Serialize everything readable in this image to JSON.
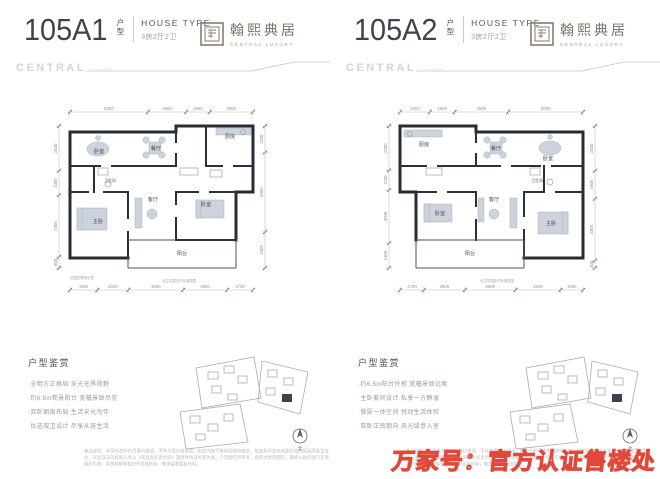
{
  "watermark": {
    "text": "万家号：官方认证售楼处",
    "color": "#e2483a"
  },
  "panels": [
    {
      "header": {
        "number": "105A1",
        "unit_top": "户",
        "unit_bottom": "型",
        "house_type": "HOUSE TYPE",
        "layout": "3房2厅2卫"
      },
      "brand": {
        "name": "翰熙典居",
        "sub": "CENTRAL LUXURY"
      },
      "deco": {
        "central": "CENTRAL",
        "luxury": "LUXURY"
      },
      "plan": {
        "dims": {
          "top": [
            "5300",
            "2600",
            "1600",
            "2950"
          ],
          "bottom": [
            "1800",
            "2040",
            "3600",
            "2900",
            "1700"
          ],
          "left": [
            "2400",
            "1300",
            "3300",
            "600"
          ],
          "right": [
            "1100",
            "3300",
            "1500"
          ]
        },
        "rooms": [
          {
            "label": "卧室",
            "x": 49,
            "y": 51
          },
          {
            "label": "餐厅",
            "x": 106,
            "y": 48
          },
          {
            "label": "厨房",
            "x": 180,
            "y": 36
          },
          {
            "label": "卫生间",
            "x": 60,
            "y": 80,
            "small": true
          },
          {
            "label": "客厅",
            "x": 103,
            "y": 99
          },
          {
            "label": "卧室",
            "x": 156,
            "y": 104
          },
          {
            "label": "主卧",
            "x": 48,
            "y": 121
          },
          {
            "label": "阳台",
            "x": 132,
            "y": 153
          }
        ],
        "notes": [
          {
            "text": "花园边界线示意",
            "x": 20,
            "y": 177
          },
          {
            "text": "业主花园交付标准范围",
            "x": 112,
            "y": 180
          }
        ]
      },
      "features": {
        "heading": "户型鉴赏",
        "items": [
          "·全明方正格局 采光无界视野",
          "·约6.5m观景阳台 宽幅景致尽览",
          "·双卧朝南布局 生活采光为伴",
          "·优选双卫设计 尽享从容生活"
        ]
      },
      "site": {
        "north": "北"
      },
      "disclaimer": "备注说明：本宣传资料仅为要约邀请，不作为要约或承诺，相关内容不排除因政府规划、规定及开发商未能控制的原因而发生变化，买卖双方的权利义务以《商品房买卖合同》及附件协议约定为准。户型图仅供参考，面积为建筑面积，最终以政府部门实测面积为准。本资料解释权归开发商所有，敬请留意最新资料。"
    },
    {
      "header": {
        "number": "105A2",
        "unit_top": "户",
        "unit_bottom": "型",
        "house_type": "HOUSE TYPE",
        "layout": "3房2厅2卫"
      },
      "brand": {
        "name": "翰熙典居",
        "sub": "CENTRAL LUXURY"
      },
      "deco": {
        "central": "CENTRAL",
        "luxury": "LUXURY"
      },
      "plan": {
        "dims": {
          "top": [
            "2000",
            "1650",
            "3600",
            "5000"
          ],
          "bottom": [
            "1700",
            "2900",
            "3600",
            "3200",
            "1600"
          ],
          "left": [
            "2500",
            "1100",
            "3000",
            "1400"
          ],
          "right": [
            "2400",
            "1500",
            "3300",
            "400"
          ]
        },
        "rooms": [
          {
            "label": "厨房",
            "x": 44,
            "y": 44
          },
          {
            "label": "餐厅",
            "x": 116,
            "y": 48
          },
          {
            "label": "卧室",
            "x": 168,
            "y": 58
          },
          {
            "label": "卫生间",
            "x": 157,
            "y": 80,
            "small": true
          },
          {
            "label": "客厅",
            "x": 114,
            "y": 99
          },
          {
            "label": "卧室",
            "x": 60,
            "y": 113
          },
          {
            "label": "主卧",
            "x": 171,
            "y": 123
          },
          {
            "label": "阳台",
            "x": 90,
            "y": 153
          }
        ],
        "notes": [
          {
            "text": "业主花园交付标准范围",
            "x": 100,
            "y": 180
          }
        ]
      },
      "features": {
        "heading": "户型鉴赏",
        "items": [
          "·约6.5m阳台外拓 宽幅景致远眺",
          "·主卧套间设计 私享一方静谧",
          "·餐厨一体空间 悦动生活体验",
          "·双卧正南朝向 风光绿意入室"
        ]
      },
      "site": {
        "north": "北"
      },
      "disclaimer": "备注说明：本宣传资料仅为要约邀请，不作为要约或承诺，相关内容不排除因政府规划、规定及开发商未能控制的原因而发生变化，买卖双方的权利义务以《商品房买卖合同》及附件协议约定为准。户型图仅供参考，面积为建筑面积，最终以政府部门实测面积为准。本资料解释权归开发商所有，敬请留意最新资料。"
    }
  ]
}
